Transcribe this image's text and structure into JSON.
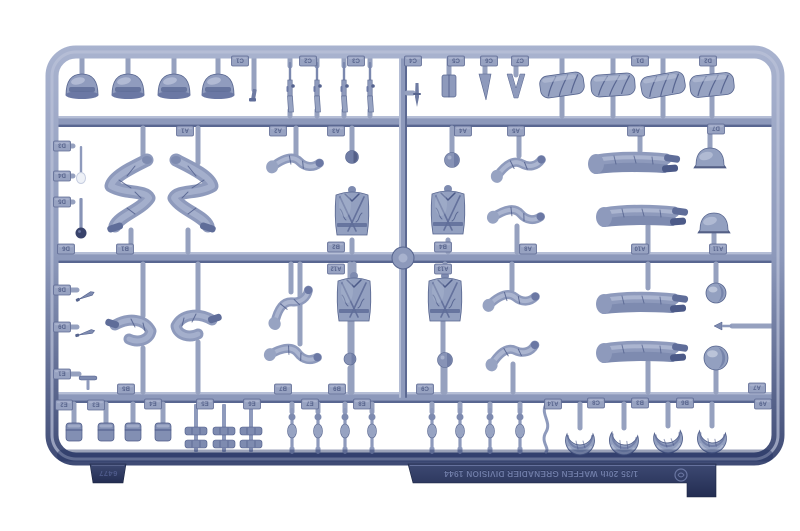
{
  "photo": {
    "subject": "Light blue-grey injection-molded plastic model sprue with 1/35 scale soldier figure parts photographed on white",
    "background_color": "#ffffff",
    "plastic_color": "#93a0c0"
  },
  "markings": {
    "title_text": "1/35 20th WAFFEN GRENADIER DIVISION 1944",
    "kit_number": "6477",
    "text_orientation": "rotated-180",
    "logo": "dragon-logo"
  },
  "palette": {
    "plastic_mid": "#8e9abc",
    "plastic_base": "#93a0c0",
    "plastic_light": "#bcc4db",
    "plastic_dark": "#5f6d99",
    "plastic_deep": "#39436b",
    "gate": "#96a1bf",
    "rail": "#8d99bb",
    "rail_light": "#b7c0d7",
    "rail_dark": "#56648e",
    "tag_bg": "#97a2c1",
    "tag_text": "#4f5c86",
    "strip_top": "#3d4972",
    "strip_bottom": "#232d52",
    "emboss_light": "#6f7ca8",
    "emboss_dark": "#1f2949"
  },
  "sprue": {
    "frame": {
      "x": 52,
      "y": 52,
      "w": 726,
      "h": 407,
      "rx": 24,
      "stroke_w": 13
    },
    "rails_h": [
      116,
      252,
      392
    ],
    "rail_h_x": 58,
    "rail_h_w": 714,
    "rail_h_t": 11,
    "rail_v": {
      "x": 399,
      "y": 58,
      "w": 8,
      "h": 340
    },
    "hub": {
      "x": 403,
      "y": 258,
      "r": 11
    },
    "strip": {
      "pts": "408,464 716,464 716,497 687,497 687,483 413,483",
      "text_x": 541,
      "text_y": 474,
      "emblem_x": 681,
      "emblem_y": 475
    },
    "kit_tab": {
      "pts": "90,464 126,464 123,483 93,483",
      "text_x": 108,
      "text_y": 474
    }
  },
  "part_labels": [
    [
      240,
      61,
      "C1"
    ],
    [
      308,
      61,
      "C2"
    ],
    [
      356,
      61,
      "C3"
    ],
    [
      413,
      61,
      "C4"
    ],
    [
      456,
      61,
      "C5"
    ],
    [
      489,
      61,
      "C6"
    ],
    [
      520,
      61,
      "C7"
    ],
    [
      640,
      61,
      "D1"
    ],
    [
      708,
      61,
      "D2"
    ],
    [
      185,
      131,
      "A1"
    ],
    [
      278,
      131,
      "A2"
    ],
    [
      336,
      131,
      "A3"
    ],
    [
      463,
      131,
      "A4"
    ],
    [
      516,
      131,
      "A5"
    ],
    [
      636,
      131,
      "A6"
    ],
    [
      716,
      129,
      "D7"
    ],
    [
      62,
      146,
      "D3"
    ],
    [
      62,
      176,
      "D4"
    ],
    [
      62,
      202,
      "D5"
    ],
    [
      66,
      249,
      "D6"
    ],
    [
      125,
      249,
      "B1"
    ],
    [
      336,
      247,
      "B2"
    ],
    [
      443,
      247,
      "B4"
    ],
    [
      528,
      249,
      "A8"
    ],
    [
      640,
      249,
      "A10"
    ],
    [
      718,
      249,
      "A11"
    ],
    [
      336,
      269,
      "A12"
    ],
    [
      443,
      269,
      "A13"
    ],
    [
      62,
      290,
      "D8"
    ],
    [
      62,
      327,
      "D9"
    ],
    [
      62,
      374,
      "E1"
    ],
    [
      126,
      389,
      "B5"
    ],
    [
      283,
      389,
      "B7"
    ],
    [
      337,
      389,
      "B9"
    ],
    [
      425,
      389,
      "C9"
    ],
    [
      757,
      388,
      "A7"
    ],
    [
      64,
      405,
      "E2"
    ],
    [
      96,
      405,
      "E3"
    ],
    [
      153,
      404,
      "E4"
    ],
    [
      205,
      404,
      "E5"
    ],
    [
      252,
      404,
      "E6"
    ],
    [
      310,
      404,
      "E7"
    ],
    [
      362,
      404,
      "E8"
    ],
    [
      553,
      404,
      "A14"
    ],
    [
      596,
      403,
      "C8"
    ],
    [
      640,
      403,
      "B3"
    ],
    [
      685,
      403,
      "B6"
    ],
    [
      763,
      404,
      "A9"
    ]
  ],
  "parts": [
    [
      "cap",
      82,
      86,
      0
    ],
    [
      "cap",
      128,
      86,
      0
    ],
    [
      "cap",
      174,
      86,
      0
    ],
    [
      "cap",
      218,
      86,
      0
    ],
    [
      "pistol",
      254,
      97,
      0
    ],
    [
      "rifle",
      290,
      88,
      0
    ],
    [
      "rifle",
      317,
      88,
      0
    ],
    [
      "rifle",
      344,
      88,
      0
    ],
    [
      "rifle",
      370,
      88,
      0
    ],
    [
      "dagger",
      417,
      95,
      0
    ],
    [
      "satchel",
      449,
      86,
      0
    ],
    [
      "cone",
      485,
      87,
      0
    ],
    [
      "vee",
      516,
      86,
      0
    ],
    [
      "rolledcap",
      562,
      85,
      -8
    ],
    [
      "rolledcap",
      613,
      85,
      -4
    ],
    [
      "rolledcap",
      663,
      85,
      -10
    ],
    [
      "rolledcap",
      712,
      85,
      -6
    ],
    [
      "spade",
      81,
      166,
      0
    ],
    [
      "grenade",
      81,
      216,
      0
    ],
    [
      "legsZ",
      133,
      196,
      0
    ],
    [
      "legsZ",
      190,
      196,
      1
    ],
    [
      "arm",
      296,
      164,
      10
    ],
    [
      "headdark",
      352,
      157,
      0
    ],
    [
      "torso",
      352,
      215,
      0
    ],
    [
      "torso",
      448,
      214,
      0
    ],
    [
      "head",
      452,
      160,
      0
    ],
    [
      "arm",
      519,
      167,
      -6
    ],
    [
      "legsH",
      640,
      163,
      0
    ],
    [
      "helmet",
      710,
      160,
      0
    ],
    [
      "arm",
      517,
      216,
      14
    ],
    [
      "legsH",
      648,
      216,
      0
    ],
    [
      "helmet",
      714,
      225,
      0
    ],
    [
      "blade",
      86,
      296,
      -25
    ],
    [
      "blade",
      86,
      333,
      -15
    ],
    [
      "ttool",
      88,
      378,
      0
    ],
    [
      "legsK",
      135,
      333,
      0
    ],
    [
      "legsK",
      192,
      328,
      1
    ],
    [
      "arm",
      291,
      306,
      -30
    ],
    [
      "arm",
      294,
      355,
      18
    ],
    [
      "headstick",
      350,
      359,
      0
    ],
    [
      "torso",
      354,
      301,
      0
    ],
    [
      "torso",
      445,
      301,
      0
    ],
    [
      "arm",
      512,
      300,
      4
    ],
    [
      "legsH",
      648,
      303,
      0
    ],
    [
      "ball",
      716,
      293,
      10
    ],
    [
      "arrow",
      722,
      326,
      0
    ],
    [
      "head",
      445,
      360,
      0
    ],
    [
      "arm",
      513,
      354,
      -10
    ],
    [
      "legsH",
      648,
      352,
      0
    ],
    [
      "ball",
      716,
      358,
      12
    ],
    [
      "pouch",
      74,
      432,
      0
    ],
    [
      "pouch",
      106,
      432,
      0
    ],
    [
      "pouch",
      133,
      432,
      0
    ],
    [
      "pouch",
      163,
      432,
      0
    ],
    [
      "dbar",
      196,
      437,
      0
    ],
    [
      "dbar",
      224,
      437,
      0
    ],
    [
      "dbar",
      251,
      437,
      0
    ],
    [
      "rod",
      292,
      431,
      0
    ],
    [
      "rod",
      318,
      431,
      0
    ],
    [
      "rod",
      345,
      431,
      0
    ],
    [
      "rod",
      372,
      431,
      0
    ],
    [
      "rod",
      432,
      431,
      0
    ],
    [
      "rod",
      460,
      431,
      0
    ],
    [
      "rod",
      490,
      431,
      0
    ],
    [
      "rod",
      520,
      431,
      0
    ],
    [
      "wiggle",
      546,
      428,
      0
    ],
    [
      "crescent",
      580,
      440,
      0
    ],
    [
      "crescent",
      624,
      440,
      8
    ],
    [
      "crescent",
      668,
      438,
      -6
    ],
    [
      "crescent",
      712,
      438,
      5
    ]
  ],
  "gates": {
    "v": [
      [
        82,
        58,
        76
      ],
      [
        128,
        58,
        76
      ],
      [
        174,
        58,
        76
      ],
      [
        218,
        58,
        76
      ],
      [
        254,
        58,
        90
      ],
      [
        290,
        58,
        66
      ],
      [
        317,
        58,
        66
      ],
      [
        344,
        58,
        66
      ],
      [
        370,
        58,
        66
      ],
      [
        290,
        110,
        116
      ],
      [
        317,
        110,
        116
      ],
      [
        344,
        110,
        116
      ],
      [
        370,
        110,
        116
      ],
      [
        449,
        58,
        77
      ],
      [
        485,
        58,
        76
      ],
      [
        516,
        58,
        75
      ],
      [
        562,
        58,
        75
      ],
      [
        613,
        58,
        75
      ],
      [
        663,
        58,
        75
      ],
      [
        712,
        58,
        75
      ],
      [
        562,
        95,
        116
      ],
      [
        613,
        95,
        116
      ],
      [
        663,
        95,
        116
      ],
      [
        712,
        95,
        116
      ],
      [
        143,
        128,
        163
      ],
      [
        198,
        128,
        163
      ],
      [
        131,
        230,
        252
      ],
      [
        188,
        230,
        252
      ],
      [
        296,
        128,
        157
      ],
      [
        352,
        128,
        151
      ],
      [
        352,
        240,
        252
      ],
      [
        448,
        240,
        252
      ],
      [
        452,
        128,
        152
      ],
      [
        519,
        128,
        156
      ],
      [
        640,
        128,
        151
      ],
      [
        710,
        128,
        149
      ],
      [
        517,
        226,
        252
      ],
      [
        648,
        226,
        252
      ],
      [
        714,
        234,
        252
      ],
      [
        354,
        264,
        282
      ],
      [
        445,
        264,
        282
      ],
      [
        352,
        318,
        392
      ],
      [
        443,
        318,
        392
      ],
      [
        143,
        264,
        316
      ],
      [
        198,
        264,
        312
      ],
      [
        143,
        348,
        392
      ],
      [
        198,
        342,
        392
      ],
      [
        291,
        264,
        292
      ],
      [
        300,
        264,
        344
      ],
      [
        350,
        264,
        352
      ],
      [
        350,
        368,
        392
      ],
      [
        512,
        264,
        290
      ],
      [
        648,
        264,
        288
      ],
      [
        716,
        264,
        283
      ],
      [
        445,
        368,
        392
      ],
      [
        513,
        364,
        392
      ],
      [
        648,
        362,
        392
      ],
      [
        716,
        368,
        392
      ],
      [
        74,
        404,
        424
      ],
      [
        106,
        404,
        424
      ],
      [
        133,
        404,
        424
      ],
      [
        163,
        404,
        424
      ],
      [
        292,
        404,
        412
      ],
      [
        318,
        404,
        412
      ],
      [
        345,
        404,
        412
      ],
      [
        372,
        404,
        412
      ],
      [
        432,
        404,
        412
      ],
      [
        460,
        404,
        412
      ],
      [
        490,
        404,
        412
      ],
      [
        520,
        404,
        412
      ],
      [
        580,
        404,
        428
      ],
      [
        624,
        404,
        428
      ],
      [
        668,
        404,
        426
      ],
      [
        712,
        404,
        426
      ],
      [
        580,
        450,
        458
      ],
      [
        624,
        450,
        458
      ],
      [
        668,
        448,
        458
      ],
      [
        712,
        448,
        458
      ]
    ],
    "h": [
      [
        93,
        407,
        413
      ],
      [
        146,
        58,
        73
      ],
      [
        176,
        58,
        73
      ],
      [
        202,
        58,
        73
      ],
      [
        290,
        58,
        77
      ],
      [
        327,
        58,
        77
      ],
      [
        374,
        58,
        79
      ],
      [
        326,
        732,
        772
      ]
    ]
  }
}
